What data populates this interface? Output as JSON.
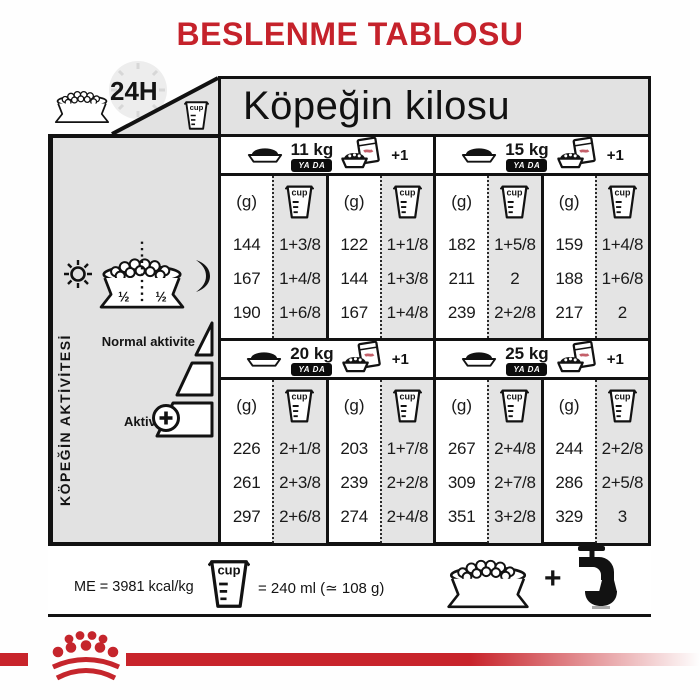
{
  "title": "BESLENME TABLOSU",
  "header": {
    "hours_label": "24H",
    "kilos_label": "Köpeğin kilosu"
  },
  "or_label": "YA DA",
  "plus_one": "+1",
  "columns": {
    "grams": "(g)",
    "cup_word": "cup"
  },
  "sidebar": {
    "vertical_label": "KÖPEĞİN AKTİVİTESİ",
    "half": "½",
    "normal_activity_label": "Normal aktivite",
    "activity_label": "Aktivite"
  },
  "quadrants": [
    {
      "weight": "11 kg",
      "rows": [
        [
          "144",
          "1+3/8",
          "122",
          "1+1/8"
        ],
        [
          "167",
          "1+4/8",
          "144",
          "1+3/8"
        ],
        [
          "190",
          "1+6/8",
          "167",
          "1+4/8"
        ]
      ]
    },
    {
      "weight": "15 kg",
      "rows": [
        [
          "182",
          "1+5/8",
          "159",
          "1+4/8"
        ],
        [
          "211",
          "2",
          "188",
          "1+6/8"
        ],
        [
          "239",
          "2+2/8",
          "217",
          "2"
        ]
      ]
    },
    {
      "weight": "20 kg",
      "rows": [
        [
          "226",
          "2+1/8",
          "203",
          "1+7/8"
        ],
        [
          "261",
          "2+3/8",
          "239",
          "2+2/8"
        ],
        [
          "297",
          "2+6/8",
          "274",
          "2+4/8"
        ]
      ]
    },
    {
      "weight": "25 kg",
      "rows": [
        [
          "267",
          "2+4/8",
          "244",
          "2+2/8"
        ],
        [
          "309",
          "2+7/8",
          "286",
          "2+5/8"
        ],
        [
          "351",
          "3+2/8",
          "329",
          "3"
        ]
      ]
    }
  ],
  "footer": {
    "energy_label": "ME = 3981 kcal/kg",
    "cup_equivalence": "= 240 ml (≃ 108 g)",
    "plus_sign": "+"
  },
  "colors": {
    "red": "#c5222b",
    "cell_gray": "#e4e4e4",
    "line_black": "#121212"
  }
}
